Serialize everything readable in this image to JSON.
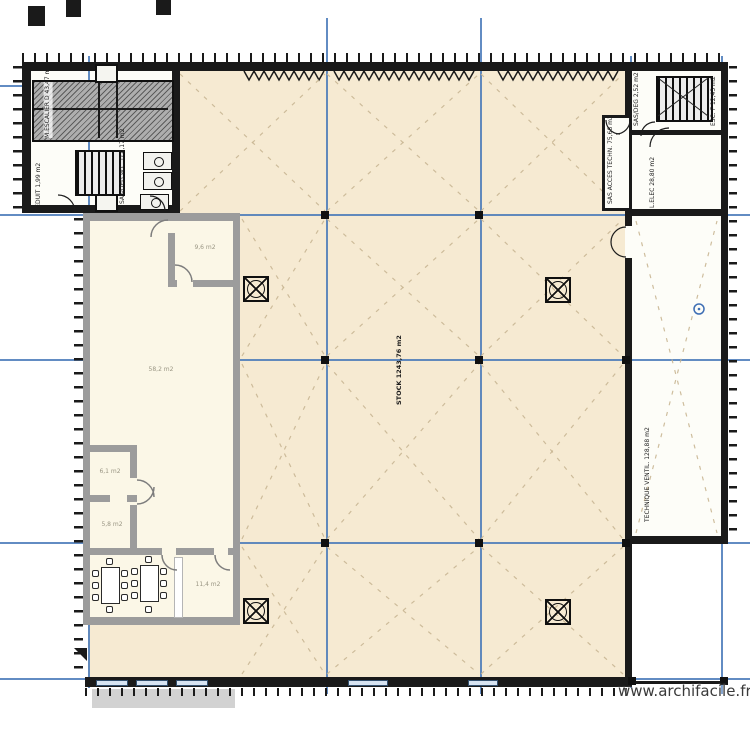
{
  "plan": {
    "watermark": "www.archifacile.fr",
    "labels": {
      "stock": "STOCK 1243,76 m2",
      "technique_ventil": "TECHNIQUE VENTIL. 128,88 m2",
      "l_elec": "L.ELEC 28,80 m2",
      "sas_acces_techn": "SAS ACCES TECHN. 75,68 m2",
      "esc_f": "ESC. F 12,43 m2",
      "sas_esc": "SAS/DEG 2,52 m2",
      "machine_room": "M.ESCALIER D 43,47 m2",
      "reduit": "REDUIT 1,99 m2",
      "sas_wc": "SAS/DEG W.C. D 4,17 m2"
    },
    "drawn_rooms": {
      "large_room_area": "58,2 m2",
      "small_room_top_area": "9,6 m2",
      "room_a_area": "6,1 m2",
      "room_b_area": "5,8 m2",
      "room_c_area": "11,4 m2"
    },
    "colors": {
      "grid_blue": "#4678b8",
      "scan_beige": "#f6ead2",
      "drawn_fill": "#fbf7e7",
      "drawn_wall": "#9c9c9c",
      "wall_black": "#1a1a1a",
      "brace_dash": "#c9b794"
    }
  }
}
